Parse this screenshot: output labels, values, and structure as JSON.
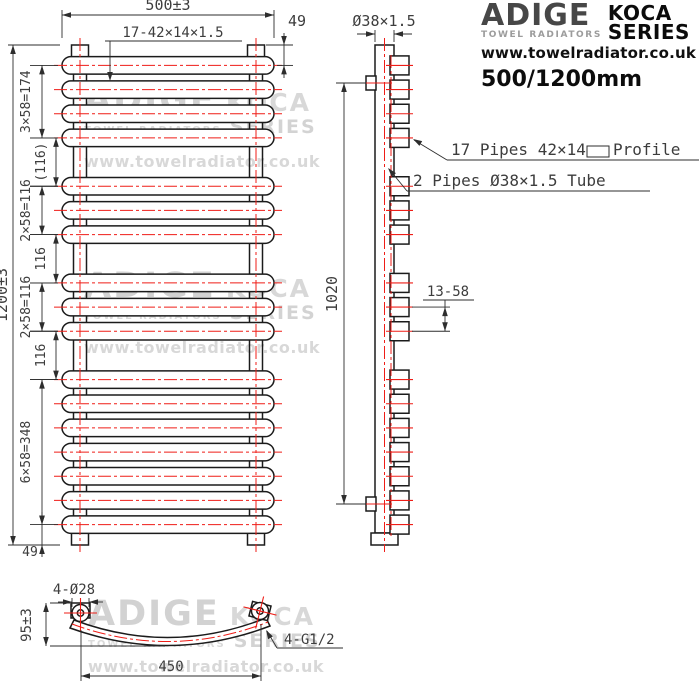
{
  "brand": {
    "name": "ADIGE",
    "tagline": "TOWEL RADIATORS",
    "series_top": "KOCA",
    "series_bottom": "SERIES",
    "website": "www.towelradiator.co.uk",
    "model": "500/1200mm"
  },
  "watermark": {
    "line1_left": "ADIGE",
    "line1_right": "KOCA",
    "line2_left": "TOWEL RADIATORS",
    "line2_right": "SERIES",
    "website": "www.towelradiator.co.uk"
  },
  "drawing": {
    "colors": {
      "line": "#1b1b1b",
      "centerline": "#ef1d17",
      "dim_text": "#3d3d3d"
    },
    "front_view": {
      "pipe_count": 17,
      "pipe_groups": [
        4,
        3,
        3,
        7
      ],
      "first_pipe_mm": 49,
      "pitch_mm": 58,
      "group_gap_mm": 116,
      "total_height_mm": 1200,
      "dims": {
        "width": "500±3",
        "pipes": "17-42×14×1.5",
        "top_offset": "49",
        "bottom_offset": "49",
        "height": "1200±3",
        "chain": [
          {
            "label": "3×58=174",
            "from": 49,
            "to": 223,
            "tier": 1
          },
          {
            "label": "(116)",
            "from": 223,
            "to": 339,
            "tier": 2
          },
          {
            "label": "2×58=116",
            "from": 339,
            "to": 455,
            "tier": 1
          },
          {
            "label": "116",
            "from": 455,
            "to": 571,
            "tier": 2
          },
          {
            "label": "2×58=116",
            "from": 571,
            "to": 687,
            "tier": 1
          },
          {
            "label": "116",
            "from": 687,
            "to": 803,
            "tier": 2
          },
          {
            "label": "6×58=348",
            "from": 803,
            "to": 1151,
            "tier": 1
          }
        ]
      }
    },
    "side_view": {
      "dims": {
        "tube": "Ø38×1.5",
        "bracket_span": "1020",
        "pipe_pitch": "13-58"
      },
      "callouts": {
        "pipes_before": "17 Pipes 42×14",
        "pipes_after": "Profile",
        "tubes": "2 Pipes Ø38×1.5 Tube"
      }
    },
    "bottom_view": {
      "dims": {
        "holes": "4-Ø28",
        "depth": "95±3",
        "width": "450",
        "thread": "4-G1/2"
      }
    }
  }
}
